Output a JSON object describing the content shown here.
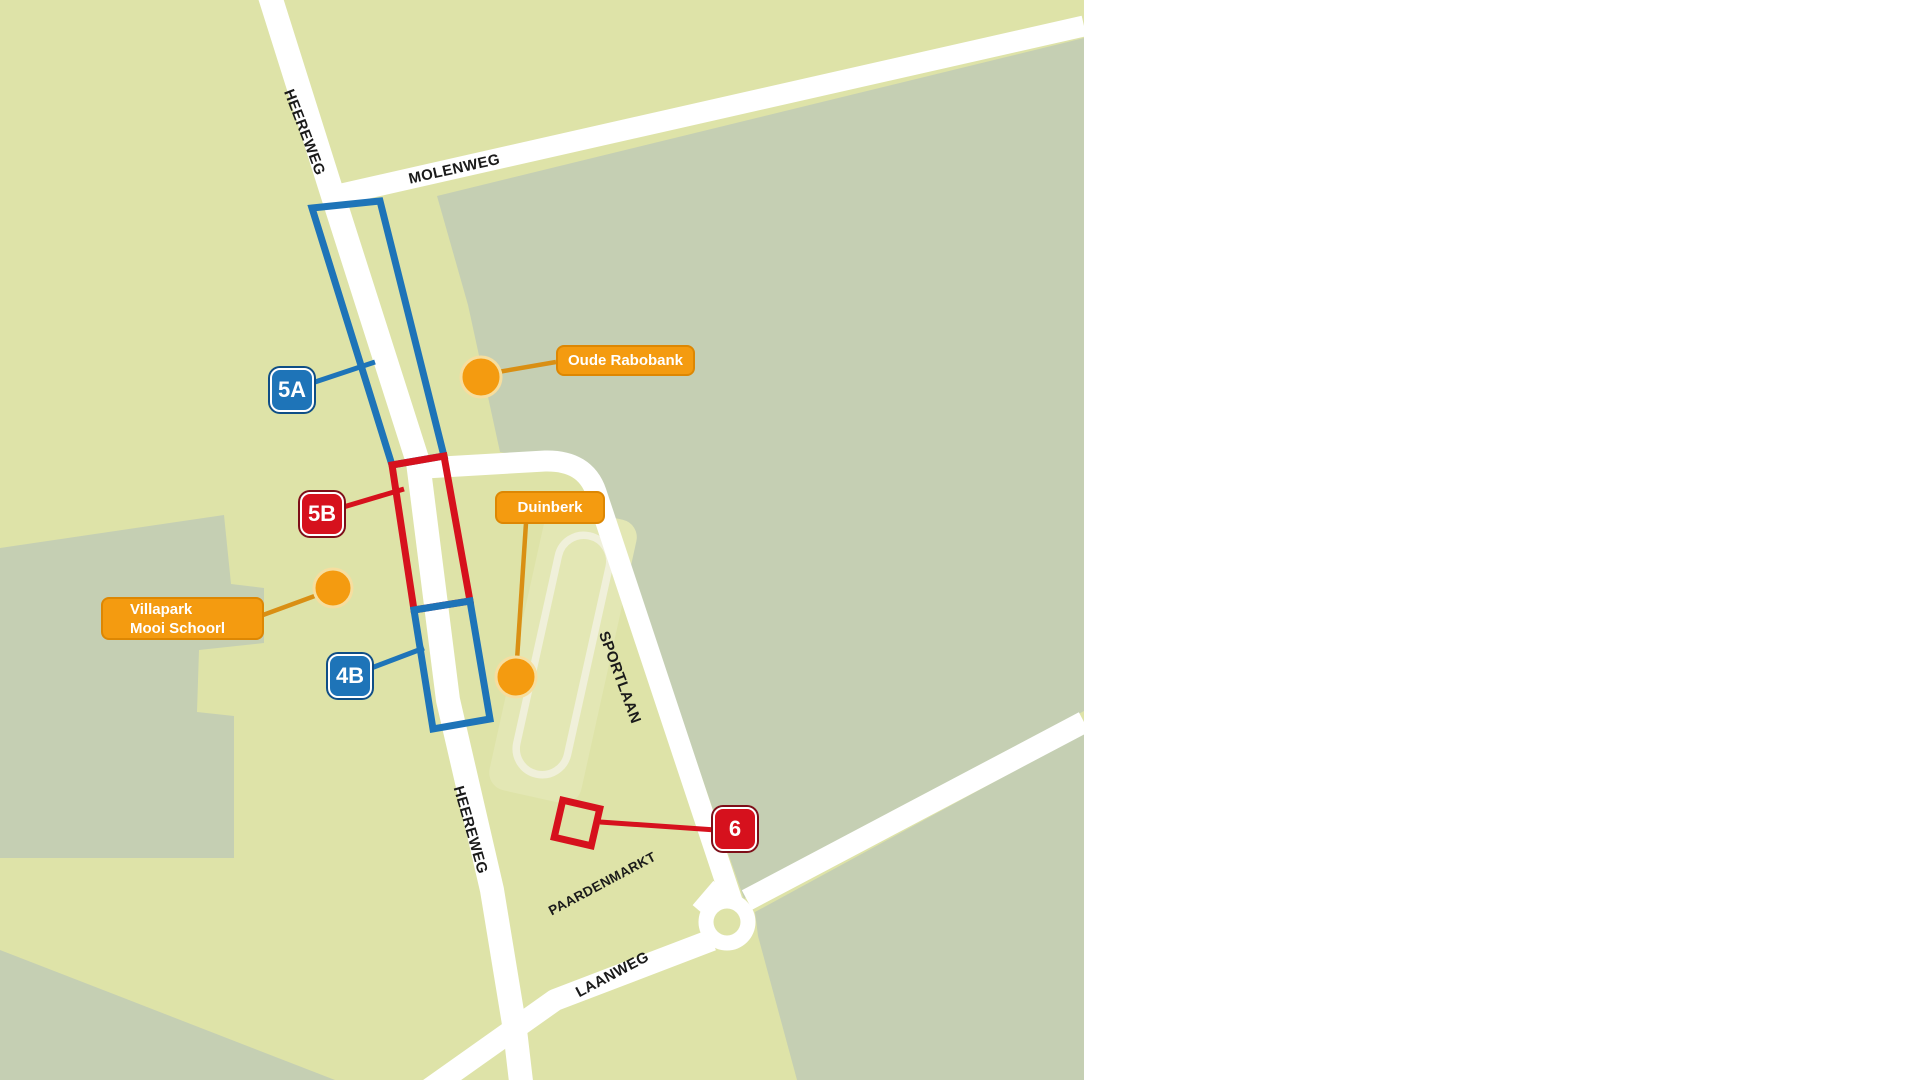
{
  "map": {
    "title": "Schoorl area site map",
    "streets": [
      {
        "id": "heereweg-top",
        "name": "HEEREWEG"
      },
      {
        "id": "molenweg",
        "name": "MOLENWEG"
      },
      {
        "id": "sportlaan",
        "name": "SPORTLAAN"
      },
      {
        "id": "heereweg-bottom",
        "name": "HEEREWEG"
      },
      {
        "id": "paardenmarkt",
        "name": "PAARDENMARKT"
      },
      {
        "id": "laanweg",
        "name": "LAANWEG"
      }
    ],
    "sites": [
      {
        "id": "site-5a",
        "label": "5A",
        "color": "#1e74b8"
      },
      {
        "id": "site-5b",
        "label": "5B",
        "color": "#d6111d"
      },
      {
        "id": "site-4b",
        "label": "4B",
        "color": "#1e74b8"
      },
      {
        "id": "site-6",
        "label": "6",
        "color": "#d6111d"
      }
    ],
    "pois": [
      {
        "id": "oude-rabobank",
        "label": "Oude Rabobank"
      },
      {
        "id": "duinberk",
        "label": "Duinberk"
      },
      {
        "id": "villapark",
        "line1": "Villapark",
        "line2": "Mooi Schoorl"
      }
    ],
    "colors": {
      "pale": "#dee3a8",
      "sage": "#c5cfb3",
      "field": "#e3e7b4",
      "trackline": "#f0f0da",
      "road": "#ffffff",
      "blue": "#1e74b8",
      "bluering": "#0f4e86",
      "red": "#d6111d",
      "redring": "#7e0e18",
      "orange": "#f49b10",
      "orangeborder": "#dd8703",
      "orangeline": "#d98f14",
      "dotring": "#f6de9f",
      "ink": "#1a1a1a"
    }
  }
}
